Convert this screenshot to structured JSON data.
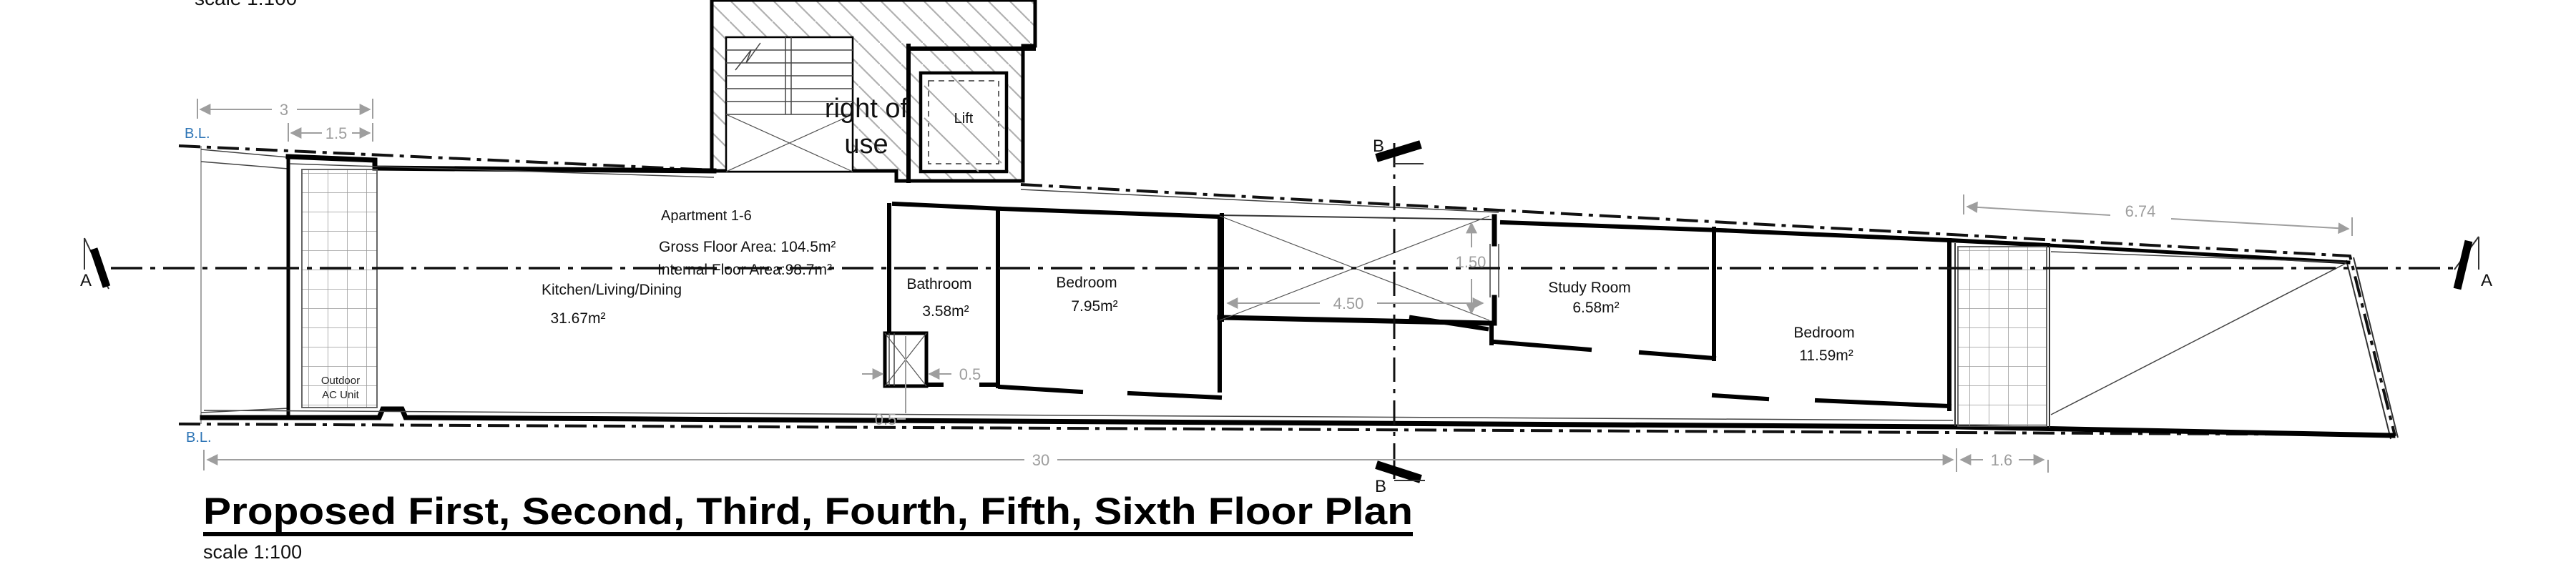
{
  "header_note": {
    "clipped_scale_text": "scale 1:100"
  },
  "title_block": {
    "title": "Proposed First, Second, Third, Fourth, Fifth, Sixth Floor Plan",
    "scale": "scale 1:100"
  },
  "boundary": {
    "label_top": "B.L.",
    "label_bottom": "B.L."
  },
  "apartment_info": {
    "name": "Apartment 1-6",
    "gross": "Gross Floor Area:  104.5m²",
    "internal": "Internal Floor Area:98.7m²"
  },
  "rooms": {
    "kitchen": {
      "name": "Kitchen/Living/Dining",
      "area": "31.67m²"
    },
    "bathroom": {
      "name": "Bathroom",
      "area": "3.58m²"
    },
    "bedroom1": {
      "name": "Bedroom",
      "area": "7.95m²"
    },
    "study": {
      "name": "Study Room",
      "area": "6.58m²"
    },
    "bedroom2": {
      "name": "Bedroom",
      "area": "11.59m²"
    }
  },
  "annotations": {
    "right_of_use_1": "right of",
    "right_of_use_2": "use",
    "lift": "Lift",
    "outdoor_ac_1": "Outdoor",
    "outdoor_ac_2": "AC Unit"
  },
  "dimensions": {
    "left_offset": "3",
    "left_offset_inner": "1.5",
    "terrace_length": "6.74",
    "overall_length": "30",
    "terrace_width": "1.6",
    "courtyard_width": "4.50",
    "courtyard_window": "1.50",
    "shaft_width": "0.5",
    "shaft_height": "0.5"
  },
  "sections": {
    "a_left": "A",
    "a_right": "A",
    "b_top": "B",
    "b_bottom": "B"
  },
  "colors": {
    "boundary_blue": "#2e75b6",
    "dim_gray": "#9e9e9e",
    "wall_black": "#000000"
  }
}
